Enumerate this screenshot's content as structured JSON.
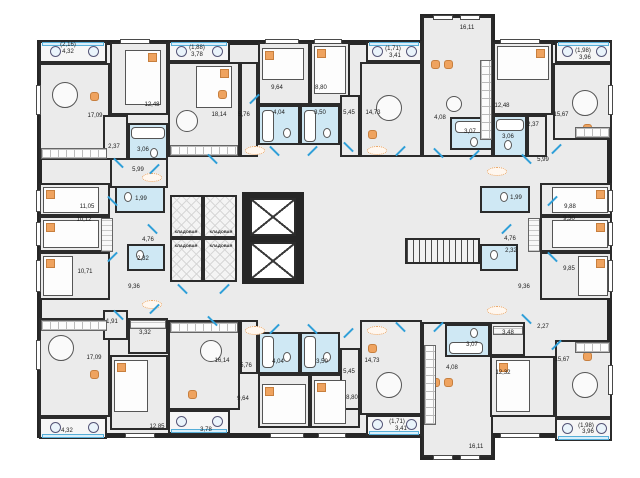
{
  "plan": {
    "type": "residential-floor-plan",
    "storage_room_label": "КЛАДОВАЯ",
    "colors": {
      "wall": "#262626",
      "floor": "#ebebeb",
      "bathroom": "#cfe8f4",
      "door_accent": "#2f9fd8",
      "furniture_accent": "#efa35f",
      "balcony_glazing": "#d9effa"
    },
    "area_labels": [
      {
        "t": "(2,16)",
        "x": 68,
        "y": 45
      },
      {
        "t": "4,32",
        "x": 68,
        "y": 52
      },
      {
        "t": "17,09",
        "x": 95,
        "y": 116
      },
      {
        "t": "12,48",
        "x": 152,
        "y": 105
      },
      {
        "t": "2,37",
        "x": 114,
        "y": 147
      },
      {
        "t": "3,06",
        "x": 143,
        "y": 150
      },
      {
        "t": "5,99",
        "x": 138,
        "y": 170
      },
      {
        "t": "(1,88)",
        "x": 197,
        "y": 48
      },
      {
        "t": "3,78",
        "x": 197,
        "y": 55
      },
      {
        "t": "18,14",
        "x": 219,
        "y": 115
      },
      {
        "t": "5,76",
        "x": 244,
        "y": 115
      },
      {
        "t": "9,64",
        "x": 277,
        "y": 88
      },
      {
        "t": "8,80",
        "x": 321,
        "y": 88
      },
      {
        "t": "4,04",
        "x": 279,
        "y": 113
      },
      {
        "t": "3,50",
        "x": 320,
        "y": 113
      },
      {
        "t": "5,45",
        "x": 349,
        "y": 113
      },
      {
        "t": "14,73",
        "x": 373,
        "y": 113
      },
      {
        "t": "(1,71)",
        "x": 393,
        "y": 49
      },
      {
        "t": "3,41",
        "x": 395,
        "y": 56
      },
      {
        "t": "16,11",
        "x": 467,
        "y": 28
      },
      {
        "t": "4,08",
        "x": 440,
        "y": 118
      },
      {
        "t": "3,07",
        "x": 470,
        "y": 132
      },
      {
        "t": "12,48",
        "x": 502,
        "y": 106
      },
      {
        "t": "2,37",
        "x": 533,
        "y": 125
      },
      {
        "t": "3,06",
        "x": 508,
        "y": 137
      },
      {
        "t": "(1,98)",
        "x": 583,
        "y": 51
      },
      {
        "t": "3,96",
        "x": 585,
        "y": 58
      },
      {
        "t": "15,67",
        "x": 561,
        "y": 115
      },
      {
        "t": "5,99",
        "x": 543,
        "y": 160
      },
      {
        "t": "11,05",
        "x": 87,
        "y": 207
      },
      {
        "t": "10,12",
        "x": 84,
        "y": 220
      },
      {
        "t": "10,71",
        "x": 85,
        "y": 272
      },
      {
        "t": "1,99",
        "x": 141,
        "y": 199
      },
      {
        "t": "4,76",
        "x": 148,
        "y": 240
      },
      {
        "t": "2,32",
        "x": 143,
        "y": 259
      },
      {
        "t": "9,36",
        "x": 134,
        "y": 287
      },
      {
        "t": "1,99",
        "x": 516,
        "y": 198
      },
      {
        "t": "9,88",
        "x": 570,
        "y": 207
      },
      {
        "t": "9,30",
        "x": 569,
        "y": 219
      },
      {
        "t": "4,76",
        "x": 510,
        "y": 239
      },
      {
        "t": "2,32",
        "x": 511,
        "y": 251
      },
      {
        "t": "9,85",
        "x": 569,
        "y": 269
      },
      {
        "t": "9,36",
        "x": 524,
        "y": 287
      },
      {
        "t": "КЛАДОВАЯ",
        "x": 186,
        "y": 232,
        "s": 1
      },
      {
        "t": "КЛАДОВАЯ",
        "x": 221,
        "y": 232,
        "s": 1
      },
      {
        "t": "КЛАДОВАЯ",
        "x": 186,
        "y": 246,
        "s": 1
      },
      {
        "t": "КЛАДОВАЯ",
        "x": 221,
        "y": 246,
        "s": 1
      },
      {
        "t": "1,91",
        "x": 112,
        "y": 322
      },
      {
        "t": "3,32",
        "x": 145,
        "y": 333
      },
      {
        "t": "17,09",
        "x": 94,
        "y": 358
      },
      {
        "t": "12,85",
        "x": 157,
        "y": 427
      },
      {
        "t": "4,32",
        "x": 67,
        "y": 431
      },
      {
        "t": "3,78",
        "x": 206,
        "y": 430
      },
      {
        "t": "16,14",
        "x": 222,
        "y": 361
      },
      {
        "t": "5,76",
        "x": 246,
        "y": 366
      },
      {
        "t": "9,64",
        "x": 243,
        "y": 399
      },
      {
        "t": "8,80",
        "x": 352,
        "y": 398
      },
      {
        "t": "4,04",
        "x": 278,
        "y": 362
      },
      {
        "t": "3,50",
        "x": 322,
        "y": 362
      },
      {
        "t": "5,45",
        "x": 349,
        "y": 372
      },
      {
        "t": "14,73",
        "x": 372,
        "y": 361
      },
      {
        "t": "(1,71)",
        "x": 397,
        "y": 422
      },
      {
        "t": "3,41",
        "x": 401,
        "y": 429
      },
      {
        "t": "16,11",
        "x": 476,
        "y": 447
      },
      {
        "t": "4,08",
        "x": 452,
        "y": 368
      },
      {
        "t": "3,07",
        "x": 472,
        "y": 345
      },
      {
        "t": "12,32",
        "x": 503,
        "y": 373
      },
      {
        "t": "3,48",
        "x": 508,
        "y": 333
      },
      {
        "t": "2,27",
        "x": 543,
        "y": 327
      },
      {
        "t": "15,67",
        "x": 562,
        "y": 360
      },
      {
        "t": "(1,98)",
        "x": 586,
        "y": 426
      },
      {
        "t": "3,96",
        "x": 588,
        "y": 432
      }
    ]
  }
}
